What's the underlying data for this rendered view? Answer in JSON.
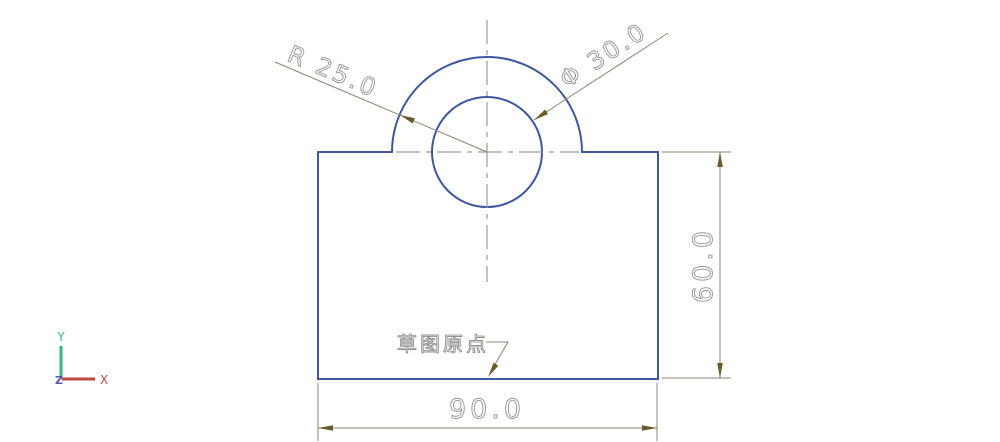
{
  "dimensions": {
    "radius": {
      "label": "R 25.0",
      "value": 25.0
    },
    "diameter": {
      "label": "Φ 30.0",
      "value": 30.0
    },
    "height": {
      "label": "60.0",
      "value": 60.0
    },
    "width": {
      "label": "90.0",
      "value": 90.0
    }
  },
  "annotations": {
    "sketch_origin_label": "草图原点"
  },
  "triad": {
    "x_label": "X",
    "y_label": "Y",
    "z_label": "Z"
  },
  "colors": {
    "model_edge": "#3f57a0",
    "centerline": "#9b9b9b",
    "dimension_line": "#8d8374",
    "arrowhead": "#6d5a2b",
    "dimension_text": "#949494",
    "axis_x_red": "#bf4a44",
    "axis_y_green": "#35b58b",
    "axis_z_purple": "#5a55a8",
    "background": "#ffffff"
  }
}
